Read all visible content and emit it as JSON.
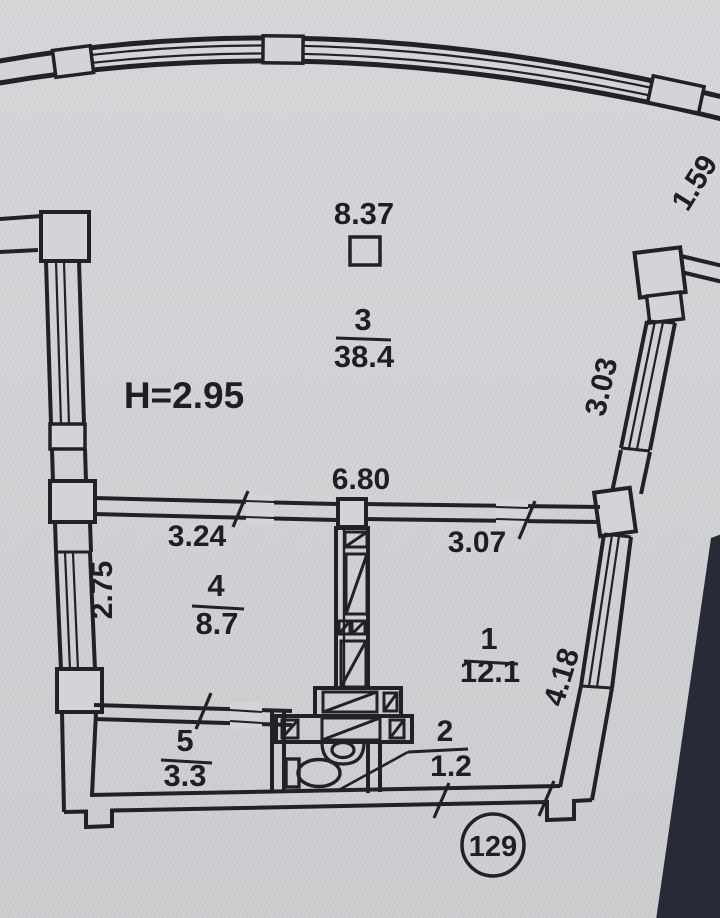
{
  "plan": {
    "type": "apartment-floor-plan",
    "height_note": "H=2.95",
    "apartment_number": "129",
    "rooms": [
      {
        "number": "3",
        "area": "38.4"
      },
      {
        "number": "4",
        "area": "8.7"
      },
      {
        "number": "1",
        "area": "12.1"
      },
      {
        "number": "5",
        "area": "3.3"
      },
      {
        "number": "2",
        "area": "1.2"
      }
    ],
    "dimensions": {
      "top": "8.37",
      "total_mid": "6.80",
      "left_mid": "3.24",
      "right_mid": "3.07",
      "room4_side": "2.75",
      "right_upper": "3.03",
      "right_lower": "4.18",
      "top_right": "1.59"
    },
    "colors": {
      "ink": "#222226",
      "paper": "#d3d4d7",
      "photo_shadow": "#272b37"
    }
  }
}
